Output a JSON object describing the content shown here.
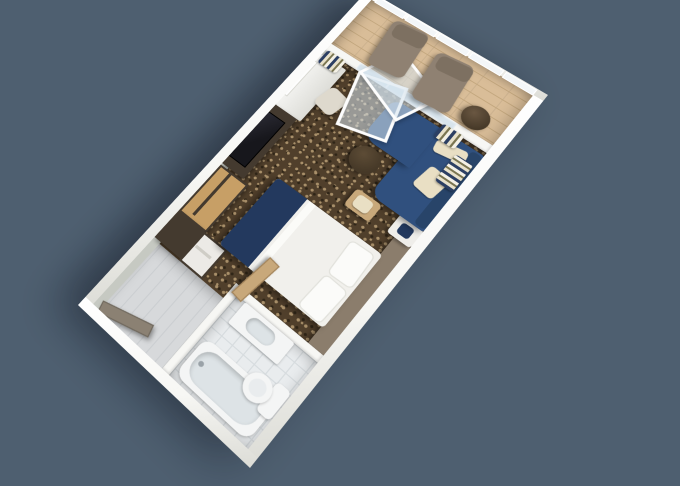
{
  "meta": {
    "kind": "3d-rendered floor plan of a cruise ship balcony stateroom",
    "camera": "overhead three-quarter view, room rotated diagonally on plain background",
    "canvas": {
      "width": 680,
      "height": 486
    }
  },
  "palette": {
    "bg": "#4e5f70",
    "wall": "#f7f7f4",
    "wallShade": "#dcdcd6",
    "wallFace": "#c6c9c2",
    "carpet": "#503f2b",
    "carpetDotLight": "#a9906a",
    "carpetDotDark": "#2f2517",
    "wood": "#d9bd98",
    "woodLine": "#c3a77e",
    "lounger": "#8f8172",
    "loungerBack": "#7d7061",
    "darkTable": "#453827",
    "sofa": "#30507e",
    "sofaBack": "#284469",
    "cream": "#e9dfc4",
    "runner": "#23395e",
    "duvet": "#f1f0ec",
    "pillow": "#fbfbf9",
    "headboard": "#8b7d6c",
    "oak": "#c79f66",
    "espresso": "#443a2f",
    "tv": "#17171c",
    "tile": "#e9ecee",
    "tileLine": "#d7dcdf",
    "vestibule": "#d7d9db",
    "vestLine": "#cbced1",
    "glass": "#d8e4ec",
    "porcelain": "#f4f5f5",
    "tubInner": "#dde3e6",
    "curtainNavy": "#2c3f63",
    "curtainCream": "#e8e1ca",
    "curtainOlive": "#7a7551",
    "doorTaupe": "#8b8173",
    "tan": "#c8a87a"
  },
  "scene": {
    "rooms": [
      {
        "name": "Balcony",
        "items": [
          "glass railing",
          "two lounge chairs",
          "round drinks table",
          "wood plank deck"
        ]
      },
      {
        "name": "Stateroom",
        "items": [
          "bed with white duvet and navy foot runner",
          "taupe headboard panel",
          "nightstand",
          "navy L-shaped sofa with cream pillows",
          "round dark side table",
          "tan ottoman",
          "vanity desk with chair and mirror",
          "flat TV on dark cabinet",
          "oak wardrobe",
          "striped curtains",
          "open glass balcony doors",
          "patterned brown carpet"
        ]
      },
      {
        "name": "Bathroom",
        "items": [
          "bathtub",
          "vanity sink",
          "toilet",
          "tiled floor",
          "open tan door"
        ]
      },
      {
        "name": "Entry",
        "items": [
          "vestibule with gray floor",
          "closet with dark doors and open shelf section",
          "entry door ajar"
        ]
      }
    ]
  }
}
